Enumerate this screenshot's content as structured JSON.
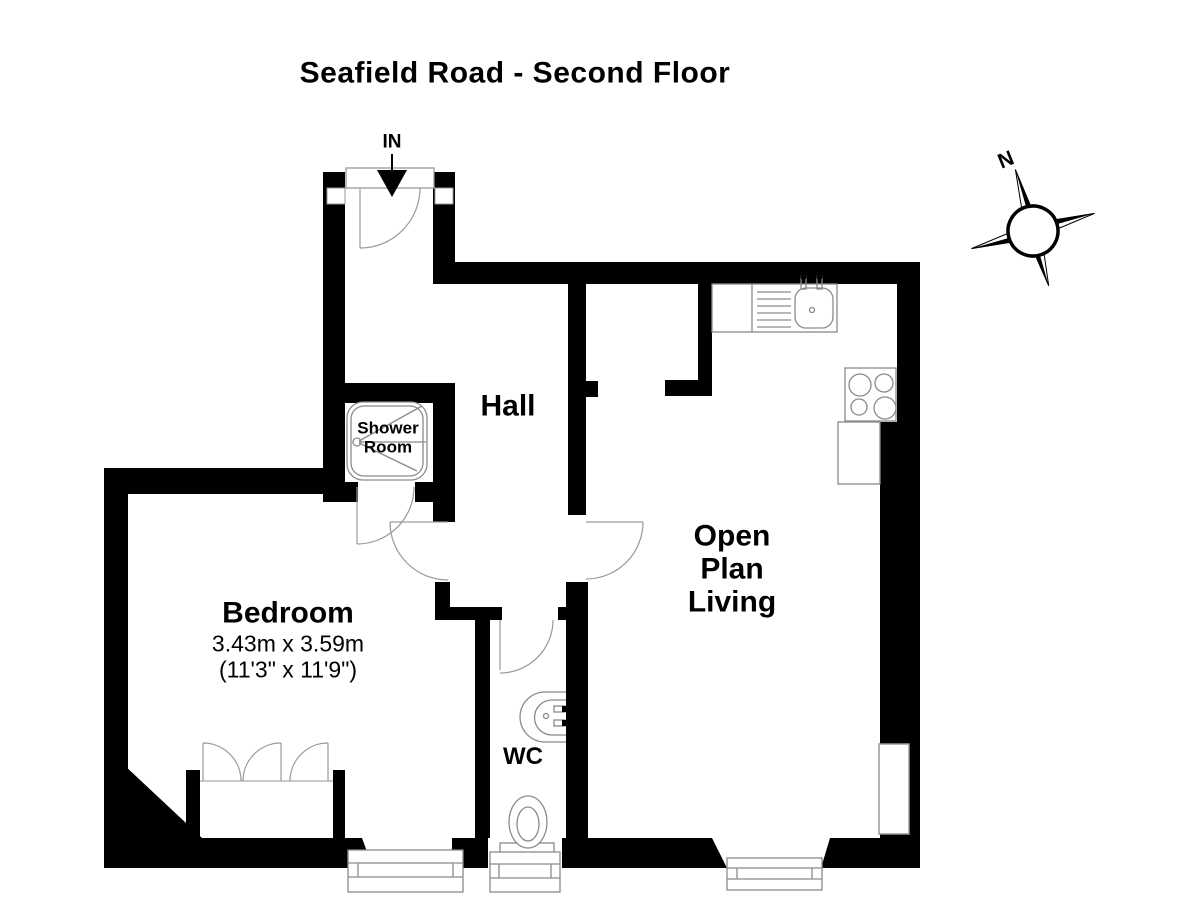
{
  "title": "Seafield Road - Second Floor",
  "entrance": {
    "label": "IN"
  },
  "compass": {
    "north_label": "N"
  },
  "rooms": {
    "hall": {
      "name": "Hall"
    },
    "shower_room": {
      "name": "Shower\nRoom"
    },
    "bedroom": {
      "name": "Bedroom",
      "dimensions_metric": "3.43m x 3.59m",
      "dimensions_imperial": "(11'3\" x 11'9\")"
    },
    "wc": {
      "name": "WC"
    },
    "open_plan_living": {
      "name": "Open\nPlan\nLiving"
    }
  },
  "colors": {
    "wall": "#000000",
    "background": "#ffffff",
    "fixture_line": "#8a8a8a"
  }
}
